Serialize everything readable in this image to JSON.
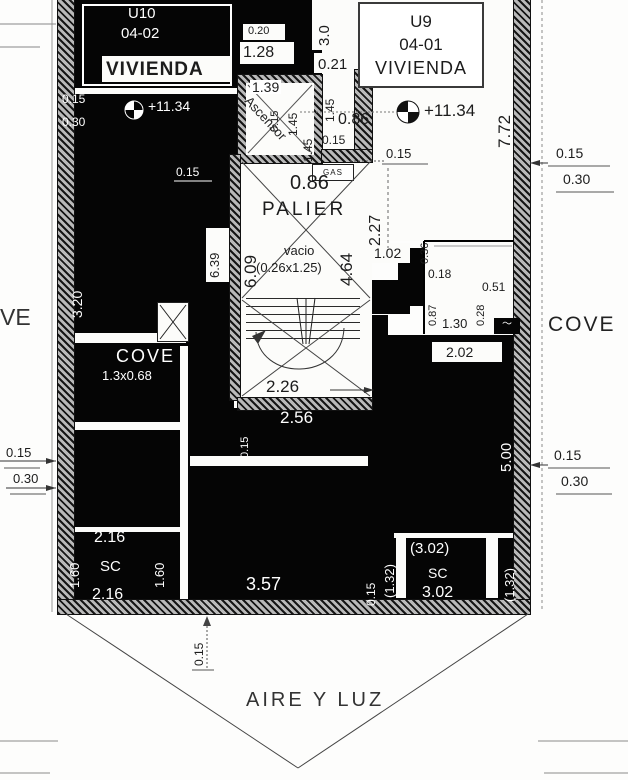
{
  "units": {
    "u10": {
      "code": "U10",
      "id": "04-02",
      "type": "VIVIENDA"
    },
    "u9": {
      "code": "U9",
      "id": "04-01",
      "type": "VIVIENDA"
    }
  },
  "levels": {
    "value": "+11.34"
  },
  "rooms": {
    "palier": "PALIER",
    "ascensor": "Ascensor",
    "vacio_label": "vacio",
    "vacio_size": "(0.26x1.25)",
    "cove_left": "COVE",
    "cove_left_size": "1.3x0.68",
    "cove_right": "COVE",
    "cove_partial": "VE",
    "aire_y_luz": "AIRE Y LUZ",
    "gas": "GAS",
    "sc": "SC"
  },
  "dims": {
    "d015": "0.15",
    "d018": "0.18",
    "d020": "0.20",
    "d021": "0.21",
    "d028": "0.28",
    "d030": "0.30",
    "d036": "0.36",
    "d051": "0.51",
    "d086": "0.86",
    "d087": "0.87",
    "d102": "1.02",
    "d128": "1.28",
    "d130": "1.30",
    "d132": "(1.32)",
    "d139": "1.39",
    "d145": "1.45",
    "d160": "1.60",
    "d202": "2.02",
    "d216": "2.16",
    "d226": "2.26",
    "d227": "2.27",
    "d256": "2.56",
    "d302": "3.02",
    "d302p": "(3.02)",
    "d30": "3.0",
    "d320": "3.20",
    "d357": "3.57",
    "d464": "4.64",
    "d500": "5.00",
    "d609": "6.09",
    "d639": "6.39",
    "d772": "7.72"
  }
}
